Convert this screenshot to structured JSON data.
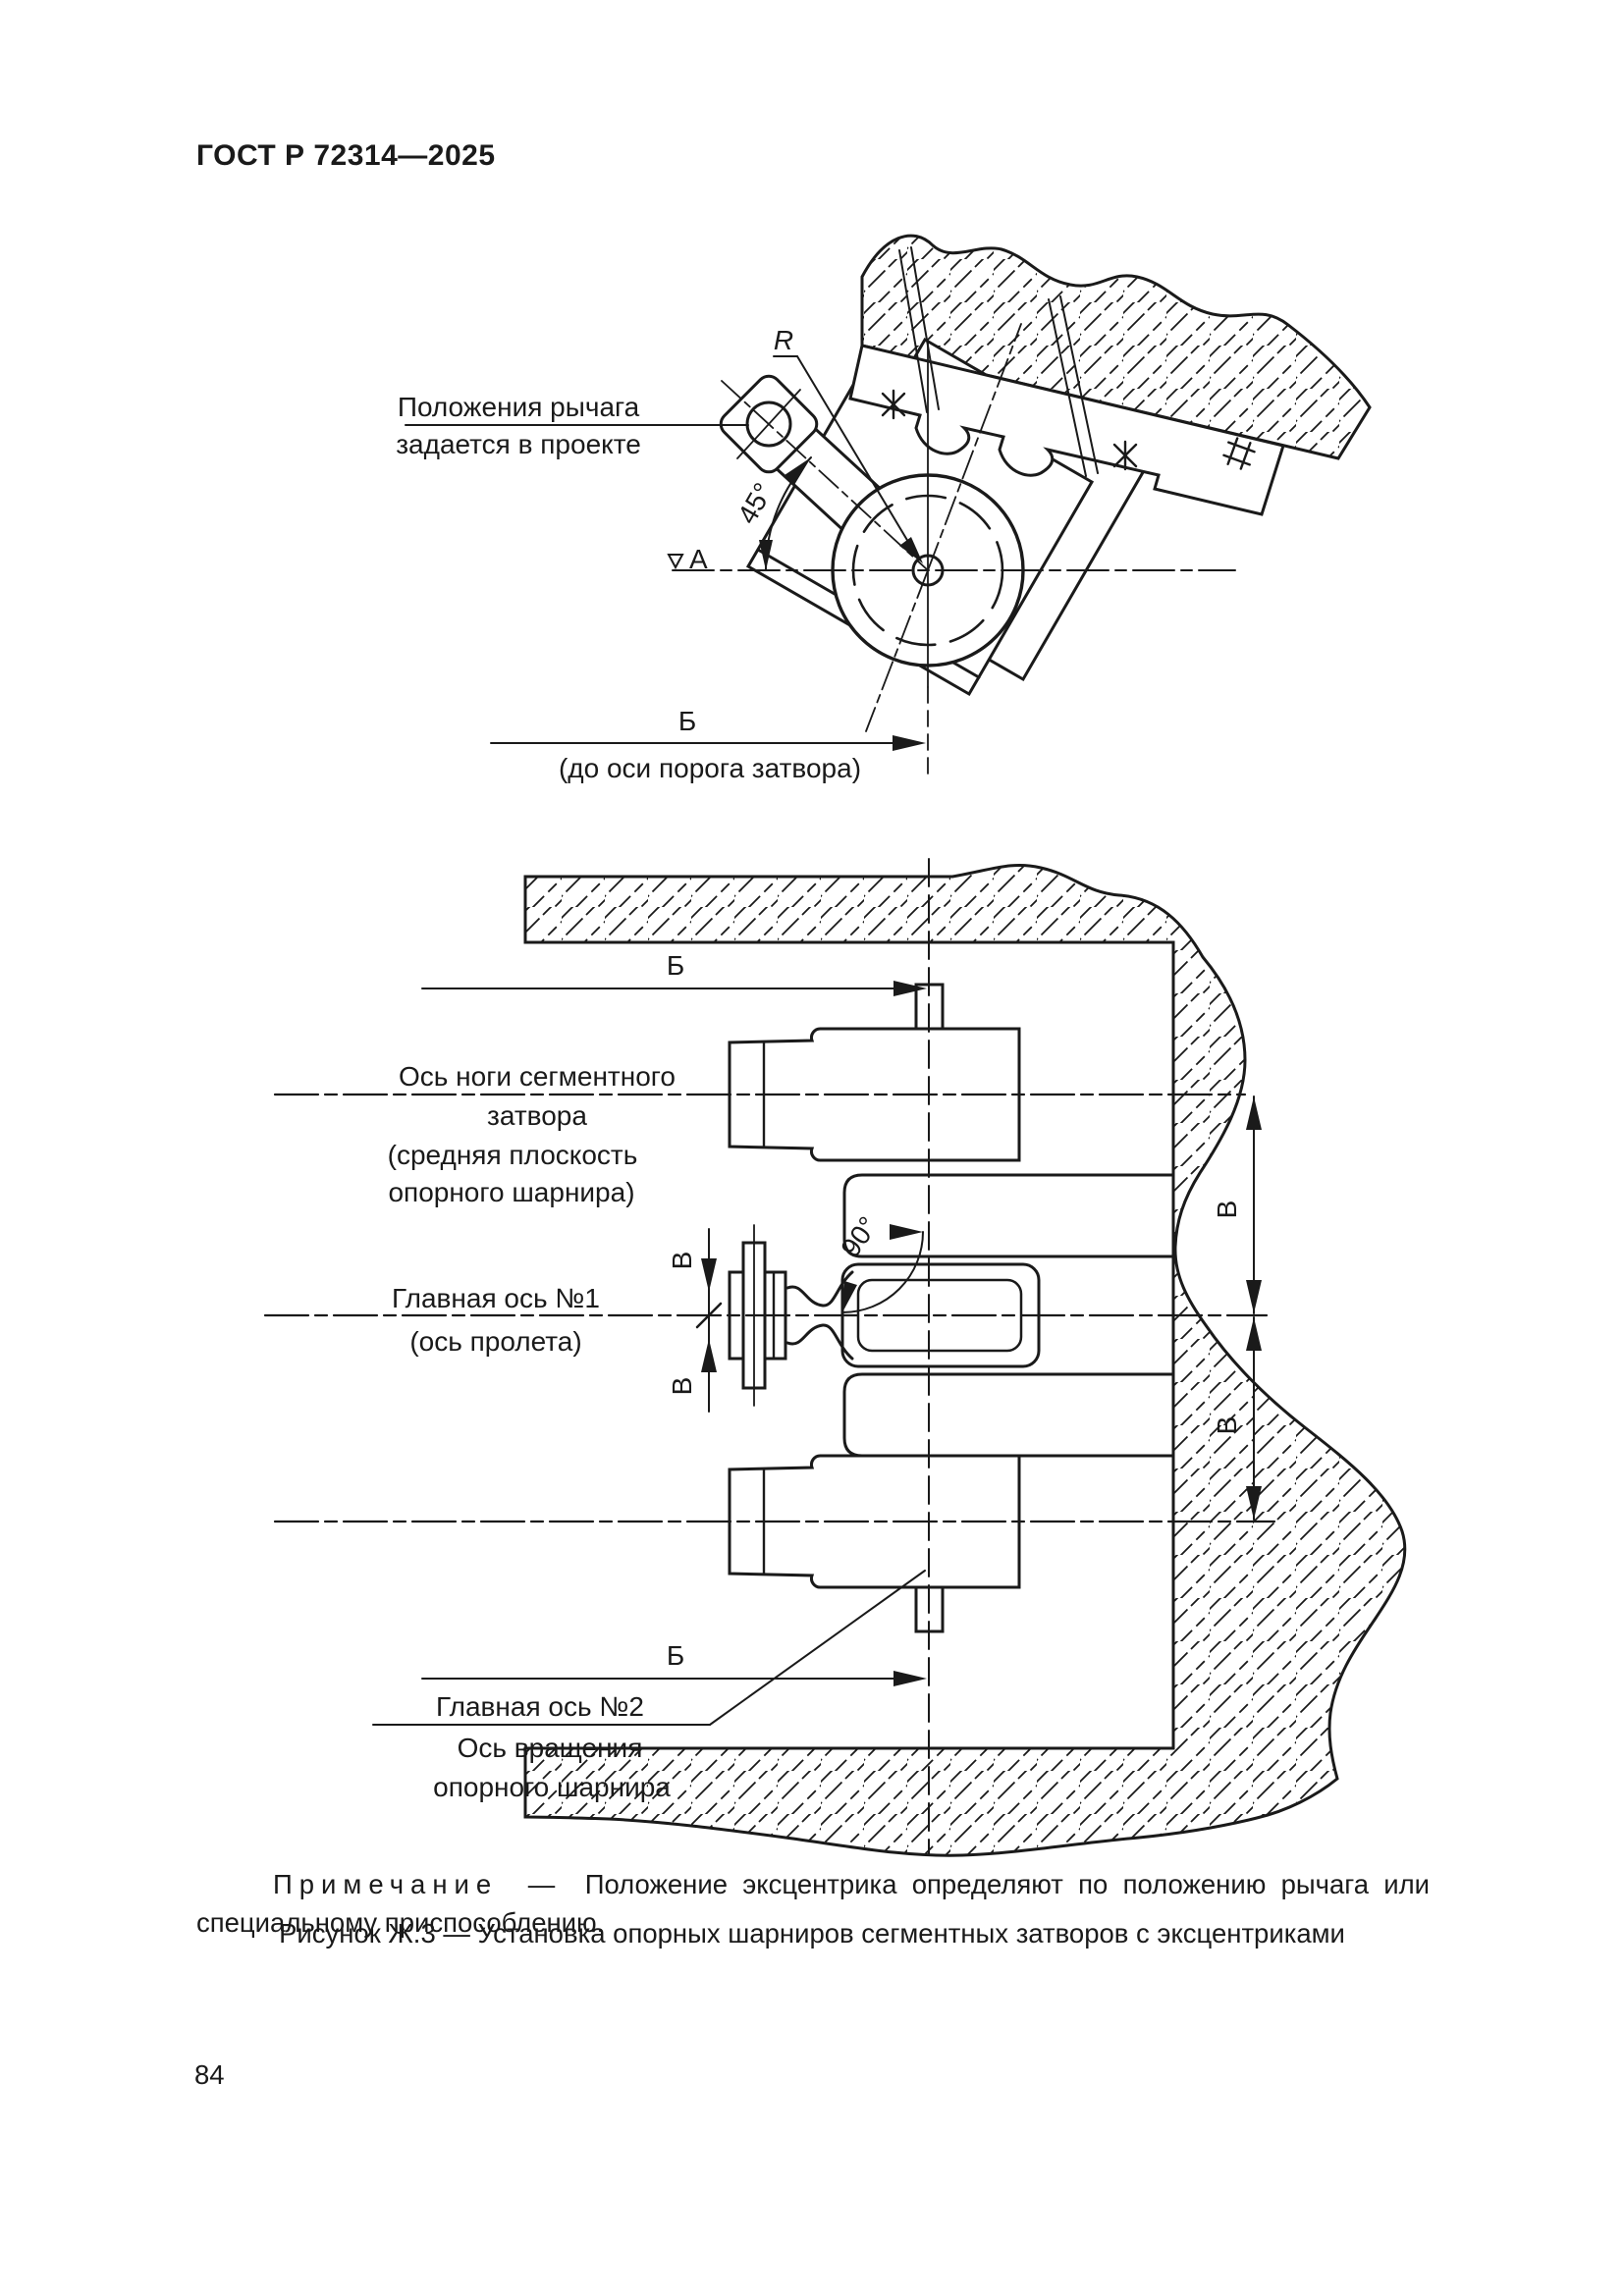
{
  "header": {
    "title": "ГОСТ Р 72314—2025"
  },
  "figure_top": {
    "lever_label_line1": "Положения рычага",
    "lever_label_line2": "задается в проекте",
    "radius_label": "R",
    "angle_label": "45°",
    "level_mark_label": "А",
    "dim_b": "Б",
    "dim_b_note": "(до оси порога затвора)"
  },
  "figure_bottom": {
    "dim_b_top": "Б",
    "dim_b_bottom": "Б",
    "leg_axis_label_line1": "Ось ноги сегментного",
    "leg_axis_label_line2": "затвора",
    "leg_axis_label_line3": "(средняя плоскость",
    "leg_axis_label_line4": "опорного шарнира)",
    "angle_label": "90°",
    "dim_v": "В",
    "main_axis1_line1": "Главная ось №1",
    "main_axis1_line2": "(ось пролета)",
    "main_axis2_line1": "Главная ось №2",
    "main_axis2_line2": "Ось вращения",
    "main_axis2_line3": "опорного шарнира"
  },
  "note": {
    "label": "Примечание",
    "dash": "—",
    "text": "Положение эксцентрика определяют по положению рычага или специальному приспособлению."
  },
  "caption": "Рисунок Ж.3 — Установка опорных шарниров сегментных затворов с эксцентриками",
  "footer": {
    "page_number": "84"
  }
}
